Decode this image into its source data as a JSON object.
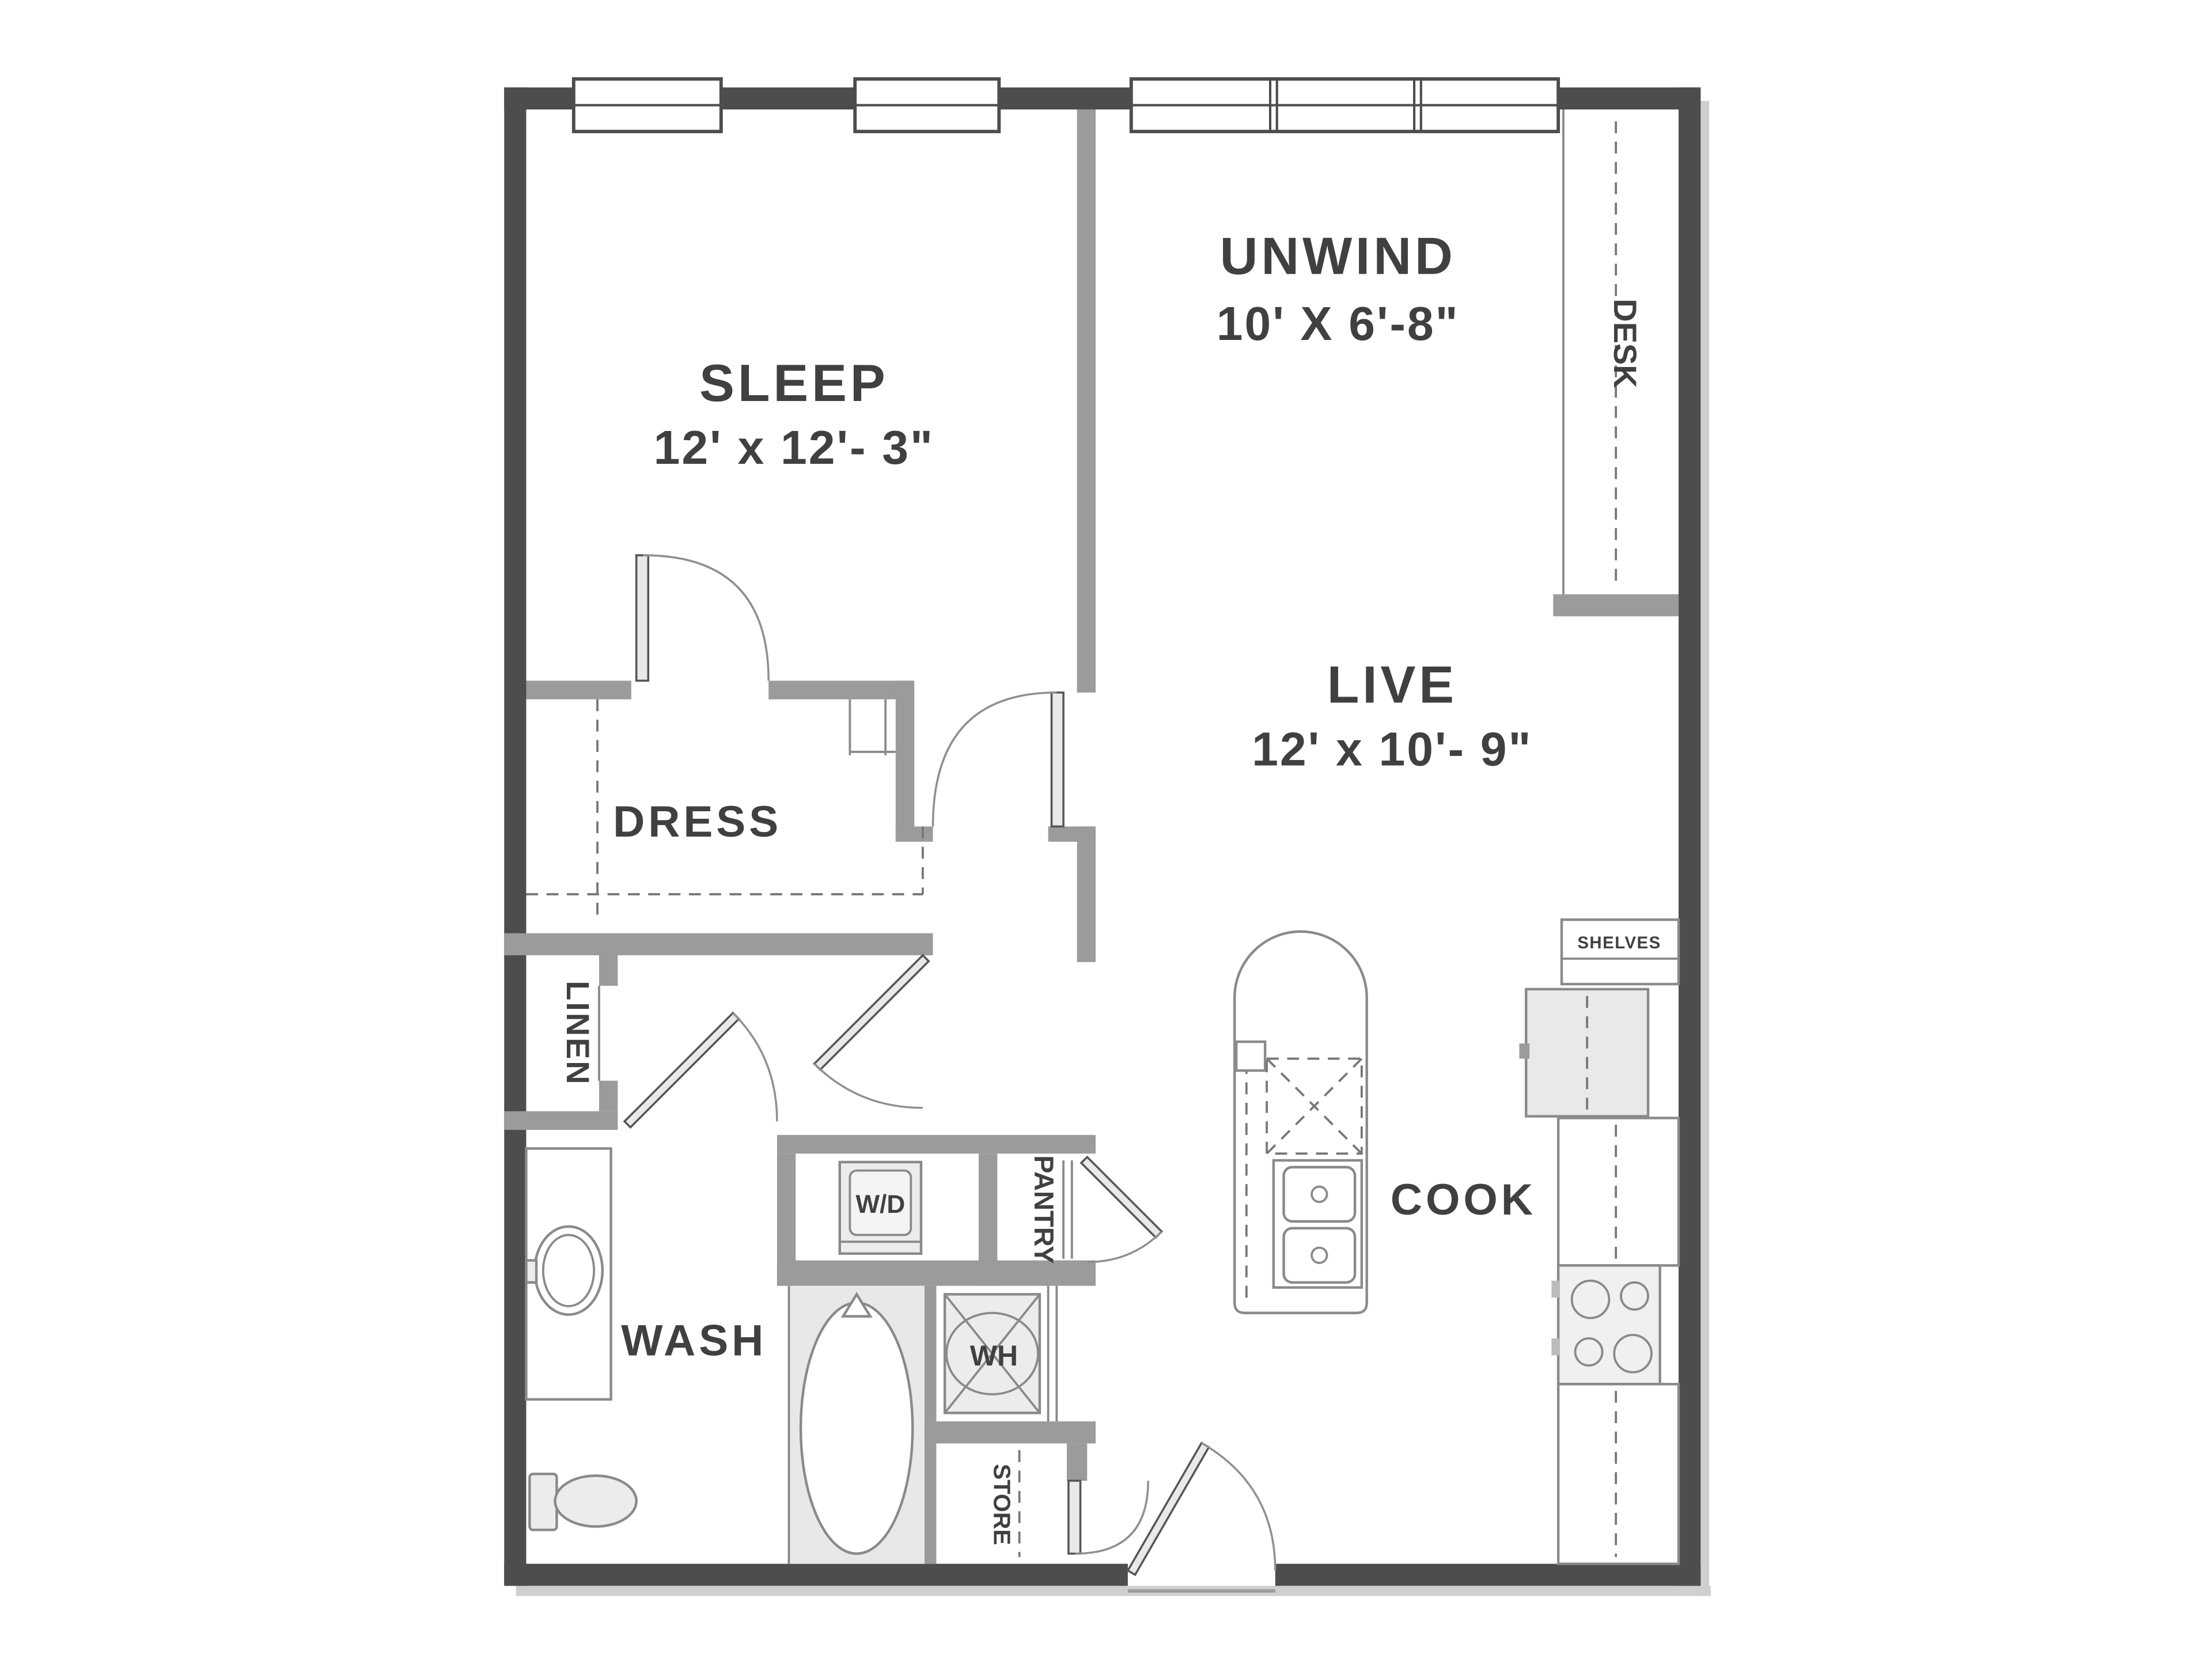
{
  "title": "One-bedroom apartment floor plan",
  "rooms": {
    "sleep": {
      "label": "SLEEP",
      "dims": "12' x 12'- 3\""
    },
    "unwind": {
      "label": "UNWIND",
      "dims": "10' X 6'-8\""
    },
    "live": {
      "label": "LIVE",
      "dims": "12' x 10'- 9\""
    },
    "cook": {
      "label": "COOK"
    },
    "wash": {
      "label": "WASH"
    },
    "dress": {
      "label": "DRESS"
    }
  },
  "closets": {
    "linen": {
      "label": "LINEN"
    },
    "pantry": {
      "label": "PANTRY"
    },
    "store": {
      "label": "STORE"
    },
    "desk": {
      "label": "DESK"
    },
    "shelves": {
      "label": "SHELVES"
    }
  },
  "appliances": {
    "washer_dryer": {
      "label": "W/D"
    },
    "water_heater": {
      "label": "WH"
    }
  },
  "colors": {
    "outer_wall": "#4d4d4d",
    "interior_wall": "#9b9b9b",
    "label_text": "#404040",
    "fixture_fill": "#ececec",
    "background": "#ffffff"
  }
}
